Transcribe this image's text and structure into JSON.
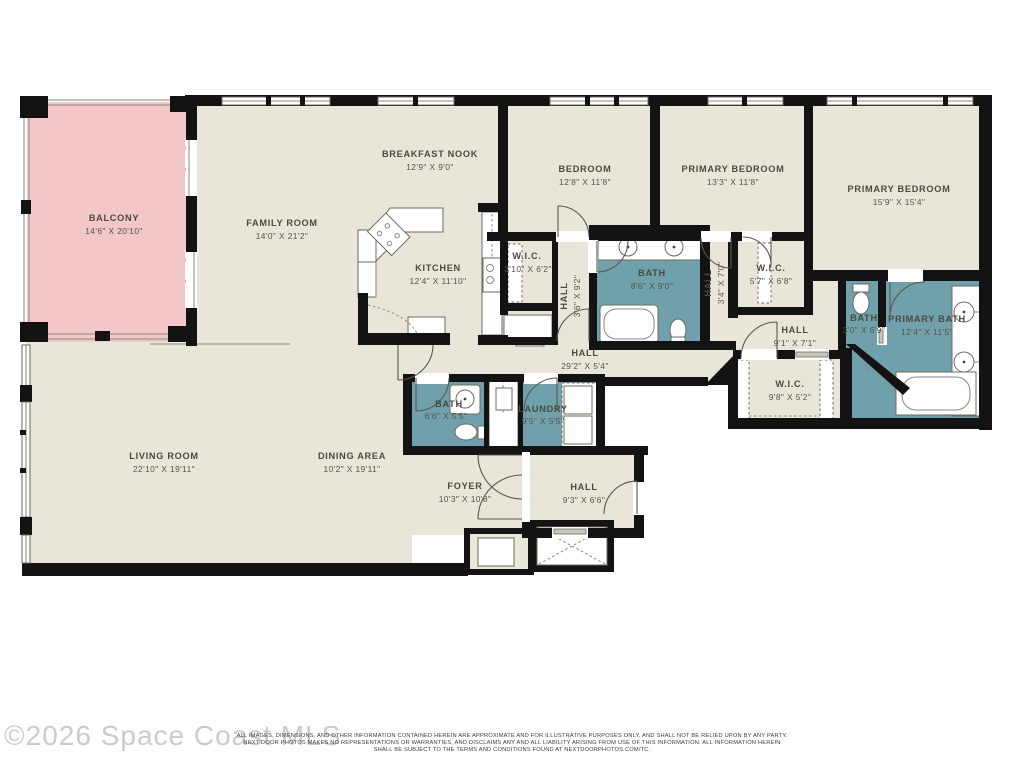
{
  "watermark": "©2026 Space Coast MLS",
  "disclaimer": {
    "line1": "ALL IMAGES, DIMENSIONS, AND OTHER INFORMATION CONTAINED HEREIN ARE APPROXIMATE AND FOR ILLUSTRATIVE PURPOSES ONLY, AND SHALL NOT BE RELIED UPON BY ANY PARTY.",
    "line2": "NEXT DOOR PHOTOS MAKES NO REPRESENTATIONS OR WARRANTIES, AND DISCLAIMS ANY AND ALL LIABILITY ARISING FROM USE OF THIS INFORMATION. ALL INFORMATION HEREIN",
    "line3": "SHALL BE SUBJECT TO THE TERMS AND CONDITIONS FOUND AT NEXTDOORPHOTOS.COM/TC."
  },
  "colors": {
    "floor": "#e9e6d9",
    "balcony": "#f3c7ca",
    "wet_rooms": "#6fa0ab",
    "walls": "#131313",
    "labels": "#4c4a40",
    "watermark": "#cbcbcb"
  },
  "rooms": {
    "balcony": {
      "name": "BALCONY",
      "dims": "14'6\" X 20'10\""
    },
    "family_room": {
      "name": "FAMILY ROOM",
      "dims": "14'0\" X 21'2\""
    },
    "breakfast_nook": {
      "name": "BREAKFAST NOOK",
      "dims": "12'9\" X 9'0\""
    },
    "kitchen": {
      "name": "KITCHEN",
      "dims": "12'4\" X 11'10\""
    },
    "bedroom": {
      "name": "BEDROOM",
      "dims": "12'8\" X 11'8\""
    },
    "primary_bedroom_1": {
      "name": "PRIMARY BEDROOM",
      "dims": "13'3\" X 11'8\""
    },
    "primary_bedroom_2": {
      "name": "PRIMARY BEDROOM",
      "dims": "15'9\" X 15'4\""
    },
    "wic_1": {
      "name": "W.I.C.",
      "dims": "3'10\" X 6'2\""
    },
    "hall_1": {
      "name": "HALL",
      "dims": "3'6\" X 9'2\""
    },
    "bath_1": {
      "name": "BATH",
      "dims": "8'6\" X 9'0\""
    },
    "hall_2": {
      "name": "HALL",
      "dims": "3'4\" X 7'0\""
    },
    "wic_2": {
      "name": "W.I.C.",
      "dims": "5'7\" X 6'8\""
    },
    "hall_3": {
      "name": "HALL",
      "dims": "9'1\" X 7'1\""
    },
    "bath_2": {
      "name": "BATH",
      "dims": "3'0\" X 6'9\""
    },
    "primary_bath": {
      "name": "PRIMARY BATH",
      "dims": "12'4\" X 11'5\""
    },
    "hall_main": {
      "name": "HALL",
      "dims": "29'2\" X 5'4\""
    },
    "wic_3": {
      "name": "W.I.C.",
      "dims": "9'8\" X 5'2\""
    },
    "bath_3": {
      "name": "BATH",
      "dims": "6'6\" X 5'5\""
    },
    "laundry": {
      "name": "LAUNDRY",
      "dims": "9'5\" X 5'5\""
    },
    "living_room": {
      "name": "LIVING ROOM",
      "dims": "22'10\" X 19'11\""
    },
    "dining_area": {
      "name": "DINING AREA",
      "dims": "10'2\" X 19'11\""
    },
    "foyer": {
      "name": "FOYER",
      "dims": "10'3\" X 10'8\""
    },
    "hall_4": {
      "name": "HALL",
      "dims": "9'3\" X 6'6\""
    }
  }
}
